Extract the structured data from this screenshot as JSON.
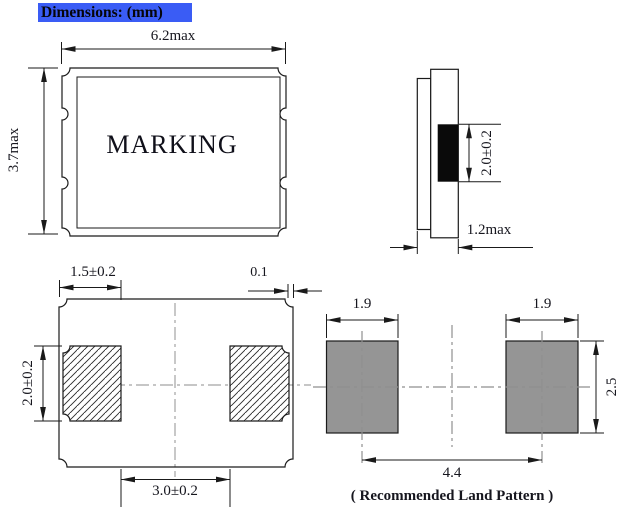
{
  "header": {
    "title": "Dimensions: (mm)",
    "highlight_color": "#3a5cf5"
  },
  "top_view": {
    "marking": "MARKING",
    "dim_width": "6.2max",
    "dim_height": "3.7max"
  },
  "side_view": {
    "dim_electrode": "2.0±0.2",
    "dim_thickness": "1.2max",
    "electrode_color": "#0a0a0a"
  },
  "bottom_view": {
    "dim_pad_width": "1.5±0.2",
    "dim_edge_gap": "0.1",
    "dim_pad_height": "2.0±0.2",
    "dim_pad_span": "3.0±0.2"
  },
  "land_pattern": {
    "caption": "( Recommended Land Pattern )",
    "dim_pad_width_left": "1.9",
    "dim_pad_width_right": "1.9",
    "dim_pad_height": "2.5",
    "dim_pitch": "4.4",
    "pad_fill_color": "#959595"
  },
  "colors": {
    "line": "#1a1a1a",
    "centerline": "#a3a3a3"
  }
}
